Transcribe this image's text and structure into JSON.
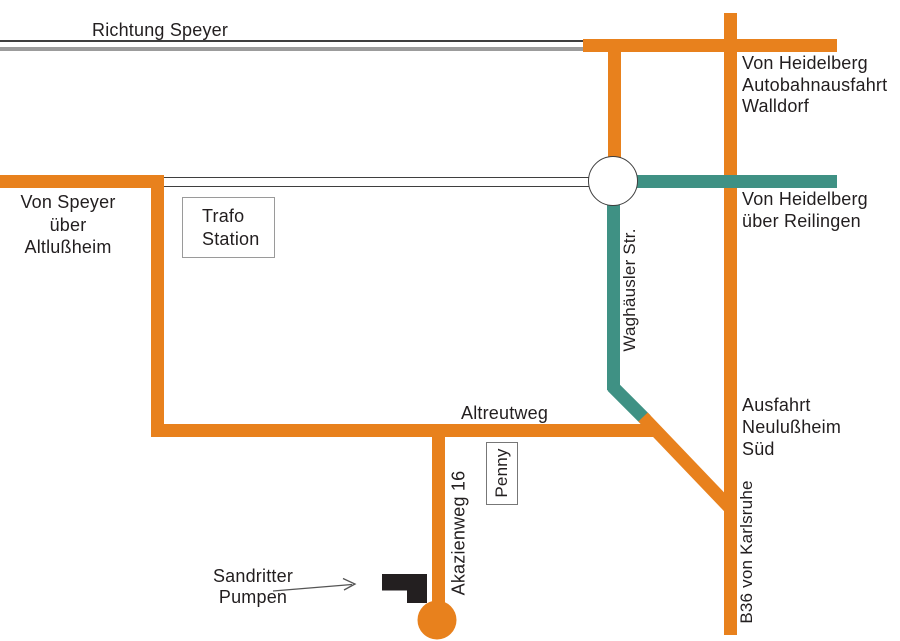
{
  "colors": {
    "route_orange": "#e8811d",
    "route_teal": "#3f9184",
    "rail_gray": "#9c9c9c",
    "text": "#221e1f"
  },
  "labels": {
    "richtung_speyer": "Richtung Speyer",
    "von_heidelberg_walldorf": "Von Heidelberg\nAutobahnausfahrt\nWalldorf",
    "von_heidelberg_reilingen": "Von Heidelberg\nüber Reilingen",
    "von_speyer_altlussheim": "Von Speyer\nüber\nAltlußheim",
    "trafo_station": "Trafo\nStation",
    "waghaeusler_str": "Waghäusler Str.",
    "altreutweg": "Altreutweg",
    "ausfahrt_neulussheim_sued": "Ausfahrt\nNeulußheim\nSüd",
    "b36_von_karlsruhe": "B36 von Karlsruhe",
    "akazienweg_16": "Akazienweg 16",
    "penny": "Penny",
    "sandritter_pumpen": "Sandritter\nPumpen"
  }
}
